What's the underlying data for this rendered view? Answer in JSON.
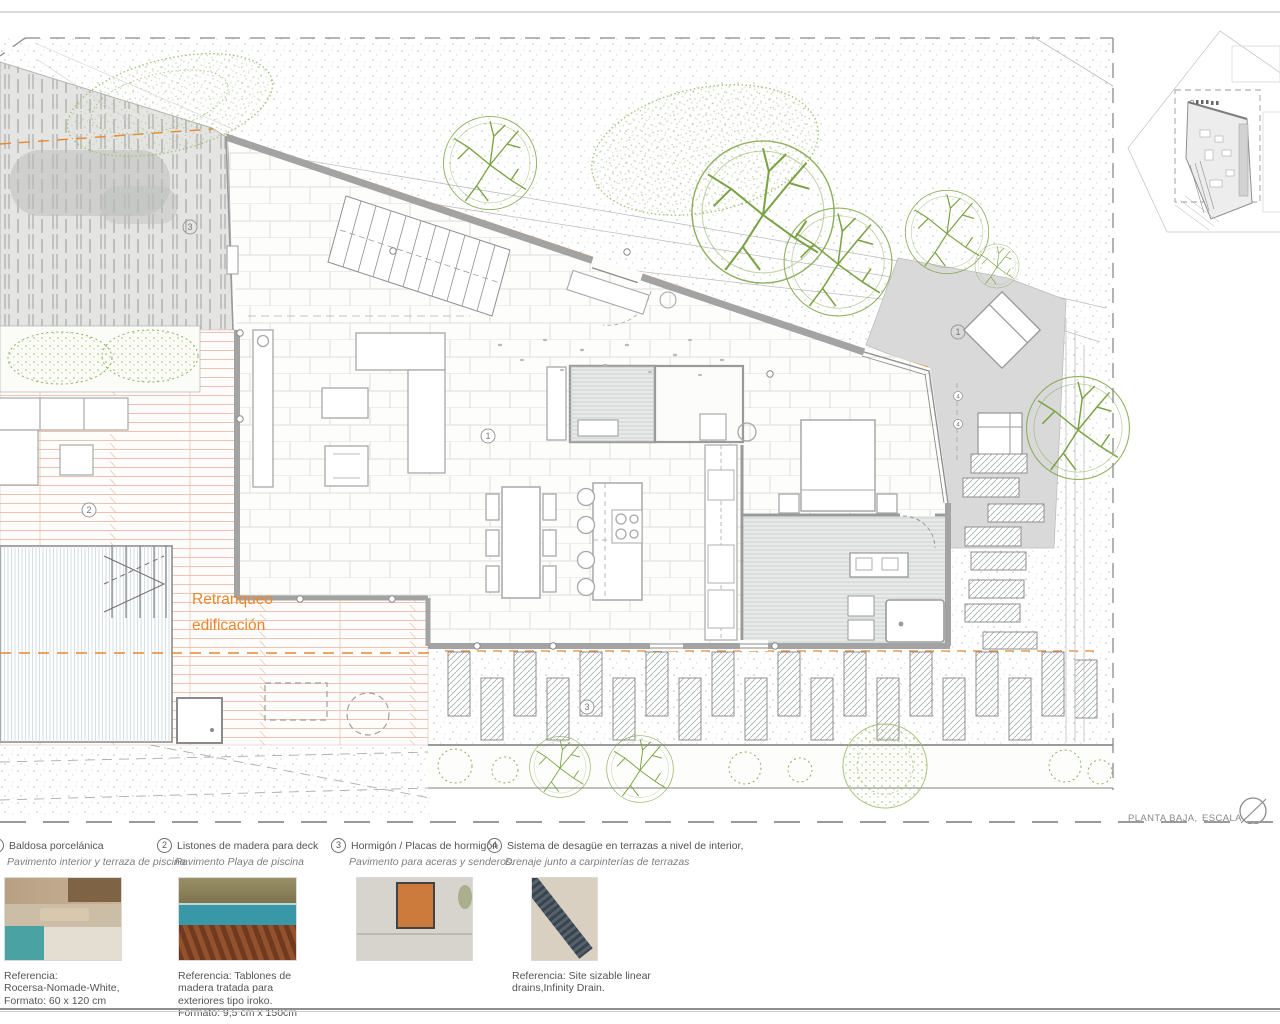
{
  "plan": {
    "name_label": "PLANTA BAJA,",
    "scale_label": "ESCALA 1/50",
    "retranqueo_line1": "Retranqueo",
    "retranqueo_line2": "edificación",
    "markers": {
      "tile": "1",
      "deck": "2",
      "concrete": "3",
      "drain": "4"
    }
  },
  "legend": {
    "items": [
      {
        "num": "1",
        "title": "Baldosa porcelánica",
        "subtitle": "Pavimento interior y terraza de piscina",
        "ref": [
          "Referencia:",
          "Rocersa-Nomade-White,",
          "Formato: 60 x 120 cm"
        ]
      },
      {
        "num": "2",
        "title": "Listones de madera para deck",
        "subtitle": "Pavimento Playa de piscina",
        "ref": [
          "Referencia: Tablones de",
          "madera tratada para",
          "exteriores tipo iroko.",
          "Formato: 9,5 cm x 150cm"
        ]
      },
      {
        "num": "3",
        "title": "Hormigón / Placas de hormigón",
        "subtitle": "Pavimento para aceras y senderos.",
        "ref": []
      },
      {
        "num": "4",
        "title": "Sistema de desagüe en terrazas a nivel de interior,",
        "subtitle": "Drenaje junto a carpinterías de terrazas",
        "ref": [
          "Referencia: Site sizable linear",
          "drains,Infinity Drain."
        ]
      }
    ]
  },
  "colors": {
    "accent_orange": "#e8872e",
    "tree_green": "#7ba244",
    "wall_gray": "#a3a3a3"
  }
}
